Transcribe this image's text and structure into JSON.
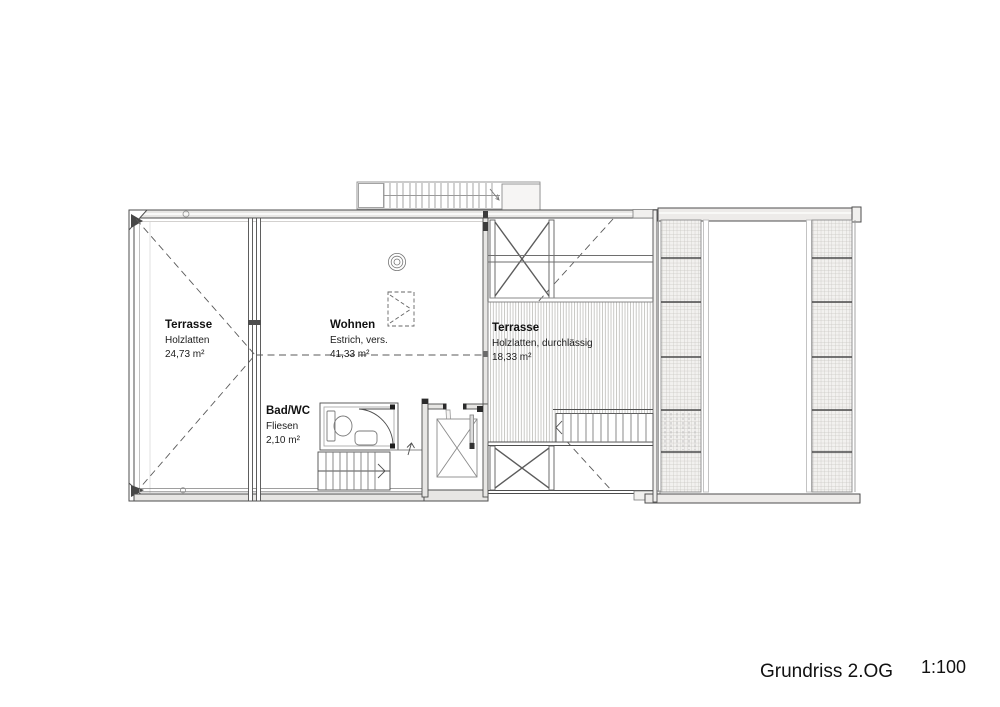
{
  "page": {
    "background": "#ffffff",
    "ink": "#4e4e4e",
    "hatch": "#b3b1ae",
    "mesh_fill": "#f2f1ef"
  },
  "titleblock": {
    "title": "Grundriss 2.OG",
    "scale": "1:100"
  },
  "rooms": {
    "terrace_left": {
      "name": "Terrasse",
      "finish": "Holzlatten",
      "area": "24,73 m²"
    },
    "living": {
      "name": "Wohnen",
      "finish": "Estrich, vers.",
      "area": "41,33 m²"
    },
    "bath": {
      "name": "Bad/WC",
      "finish": "Fliesen",
      "area": "2,10 m²"
    },
    "terrace_right": {
      "name": "Terrasse",
      "finish": "Holzlatten, durchlässig",
      "area": "18,33 m²"
    }
  }
}
